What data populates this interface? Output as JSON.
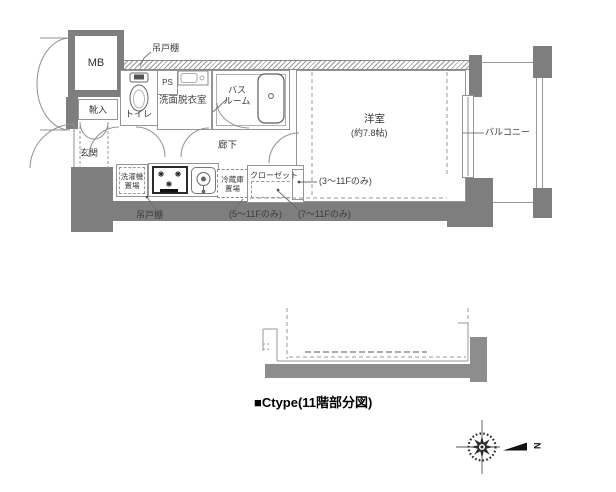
{
  "plan": {
    "rooms": {
      "mb": "MB",
      "shoe": "靴入",
      "entrance": "玄関",
      "toilet": "トイレ",
      "ps": "PS",
      "washroom": "洗面脱衣室",
      "bath_line1": "バス",
      "bath_line2": "ルーム",
      "hall": "廊下",
      "laundry_line1": "洗濯機",
      "laundry_line2": "置場",
      "fridge_line1": "冷蔵庫",
      "fridge_line2": "置場",
      "closet": "クローゼット",
      "western_room": "洋室",
      "western_room_size": "(約7.8帖)",
      "balcony": "バルコニー"
    },
    "notes": {
      "hanging_cupboard_top": "吊戸棚",
      "hanging_cupboard_bottom": "吊戸棚",
      "floors_3_11": "(3〜11Fのみ)",
      "floors_5_11": "(5〜11Fのみ)",
      "floors_7_11": "(7〜11Fのみ)"
    }
  },
  "caption": "■Ctype(11階部分図)",
  "compass": {
    "north_label": "N"
  },
  "colors": {
    "wall_gray": "#7e7e7e",
    "lower_diagram_gray": "#8d8d8d",
    "line_gray": "#909090",
    "text": "#3b3b3b"
  }
}
